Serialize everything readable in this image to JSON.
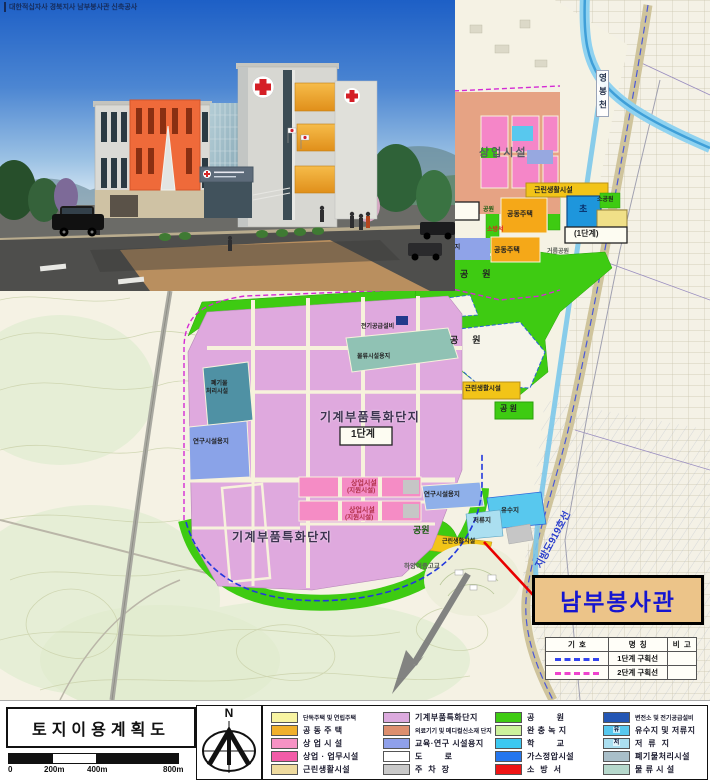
{
  "photo": {
    "caption": "대한적십자사 경북지사 남부봉사관 신축공사"
  },
  "map": {
    "labels": [
      {
        "text": "상업시설"
      },
      {
        "text": "및"
      },
      {
        "text": "대 단지"
      },
      {
        "text": "근린생활시설"
      },
      {
        "text": "1단계"
      },
      {
        "text": "공원"
      },
      {
        "text": "공동주택"
      },
      {
        "text": "초"
      },
      {
        "text": "소공원"
      },
      {
        "text": "(1단계)"
      },
      {
        "text": "소방서"
      },
      {
        "text": "공동주택"
      },
      {
        "text": "연구시설용지"
      },
      {
        "text": "공  원"
      },
      {
        "text": "전기공급설비"
      },
      {
        "text": "공  원"
      },
      {
        "text": "물류시설용지"
      },
      {
        "text": "폐기물"
      },
      {
        "text": "처리시설"
      },
      {
        "text": "근린생활시설"
      },
      {
        "text": "공 원"
      },
      {
        "text": "기계부품특화단지"
      },
      {
        "text": "1단계"
      },
      {
        "text": "연구시설용지"
      },
      {
        "text": "상업시설"
      },
      {
        "text": "(지원시설)"
      },
      {
        "text": "연구시설용지"
      },
      {
        "text": "상업시설"
      },
      {
        "text": "(지원시설)"
      },
      {
        "text": "유수지"
      },
      {
        "text": "저류지"
      },
      {
        "text": "기계부품특화단지"
      },
      {
        "text": "공원"
      },
      {
        "text": "근린생활시설"
      },
      {
        "text": "하양여중고교"
      },
      {
        "text": "지방도919호선"
      },
      {
        "text": "영봉천"
      },
      {
        "text": "거름공원"
      }
    ],
    "callout": {
      "label": "남부봉사관"
    },
    "phase_table": {
      "headers": [
        "기  호",
        "명  칭",
        "비  고"
      ],
      "rows": [
        {
          "name": "1단계 구획선",
          "color": "#3344ee",
          "remark": ""
        },
        {
          "name": "2단계 구획선",
          "color": "#ee44cc",
          "remark": ""
        }
      ]
    }
  },
  "footer": {
    "title": "토지이용계획도",
    "north_label": "N",
    "scale": {
      "labels": [
        "0",
        "200m",
        "400m",
        "800m"
      ]
    },
    "legend": {
      "columns": [
        {
          "items": [
            {
              "label": "단독주택 및 연립주택",
              "color": "#f8f4a2"
            },
            {
              "label": "공 동 주 택",
              "color": "#f0b02c"
            },
            {
              "label": "상 업 시 설",
              "color": "#f692c4"
            },
            {
              "label": "상업 · 업무시설",
              "color": "#f25ca8"
            },
            {
              "label": "근린생활시설",
              "color": "#eeda9e"
            }
          ]
        },
        {
          "items": [
            {
              "label": "기계부품특화단지",
              "color": "#dcaade"
            },
            {
              "label": "의료기기 및 메디컬신소재 단지",
              "color": "#dd8f6e"
            },
            {
              "label": "교육·연구 시설용지",
              "color": "#8fa0ea"
            },
            {
              "label": "도        로",
              "color": "#ffffff"
            },
            {
              "label": "주  차  장",
              "color": "#c9c9c9"
            }
          ]
        },
        {
          "items": [
            {
              "label": "공        원",
              "color": "#3ecb12"
            },
            {
              "label": "완 충 녹 지",
              "color": "#ccf19c"
            },
            {
              "label": "학        교",
              "color": "#3cc8f0"
            },
            {
              "label": "가스정압시설",
              "color": "#2476ee"
            },
            {
              "label": "소  방  서",
              "color": "#ee1414"
            }
          ]
        },
        {
          "items": [
            {
              "label": "변전소 및 전기공급설비",
              "color": "#2456b4"
            },
            {
              "label": "유수지 및 저류지",
              "color": "#58c8ee",
              "glyph": "유"
            },
            {
              "label": "저  류  지",
              "color": "#abdff0",
              "glyph": "저"
            },
            {
              "label": "폐기물처리시설",
              "color": "#a9bfc9"
            },
            {
              "label": "물 류 시 설",
              "color": "#b6d8cc"
            }
          ]
        }
      ]
    }
  }
}
